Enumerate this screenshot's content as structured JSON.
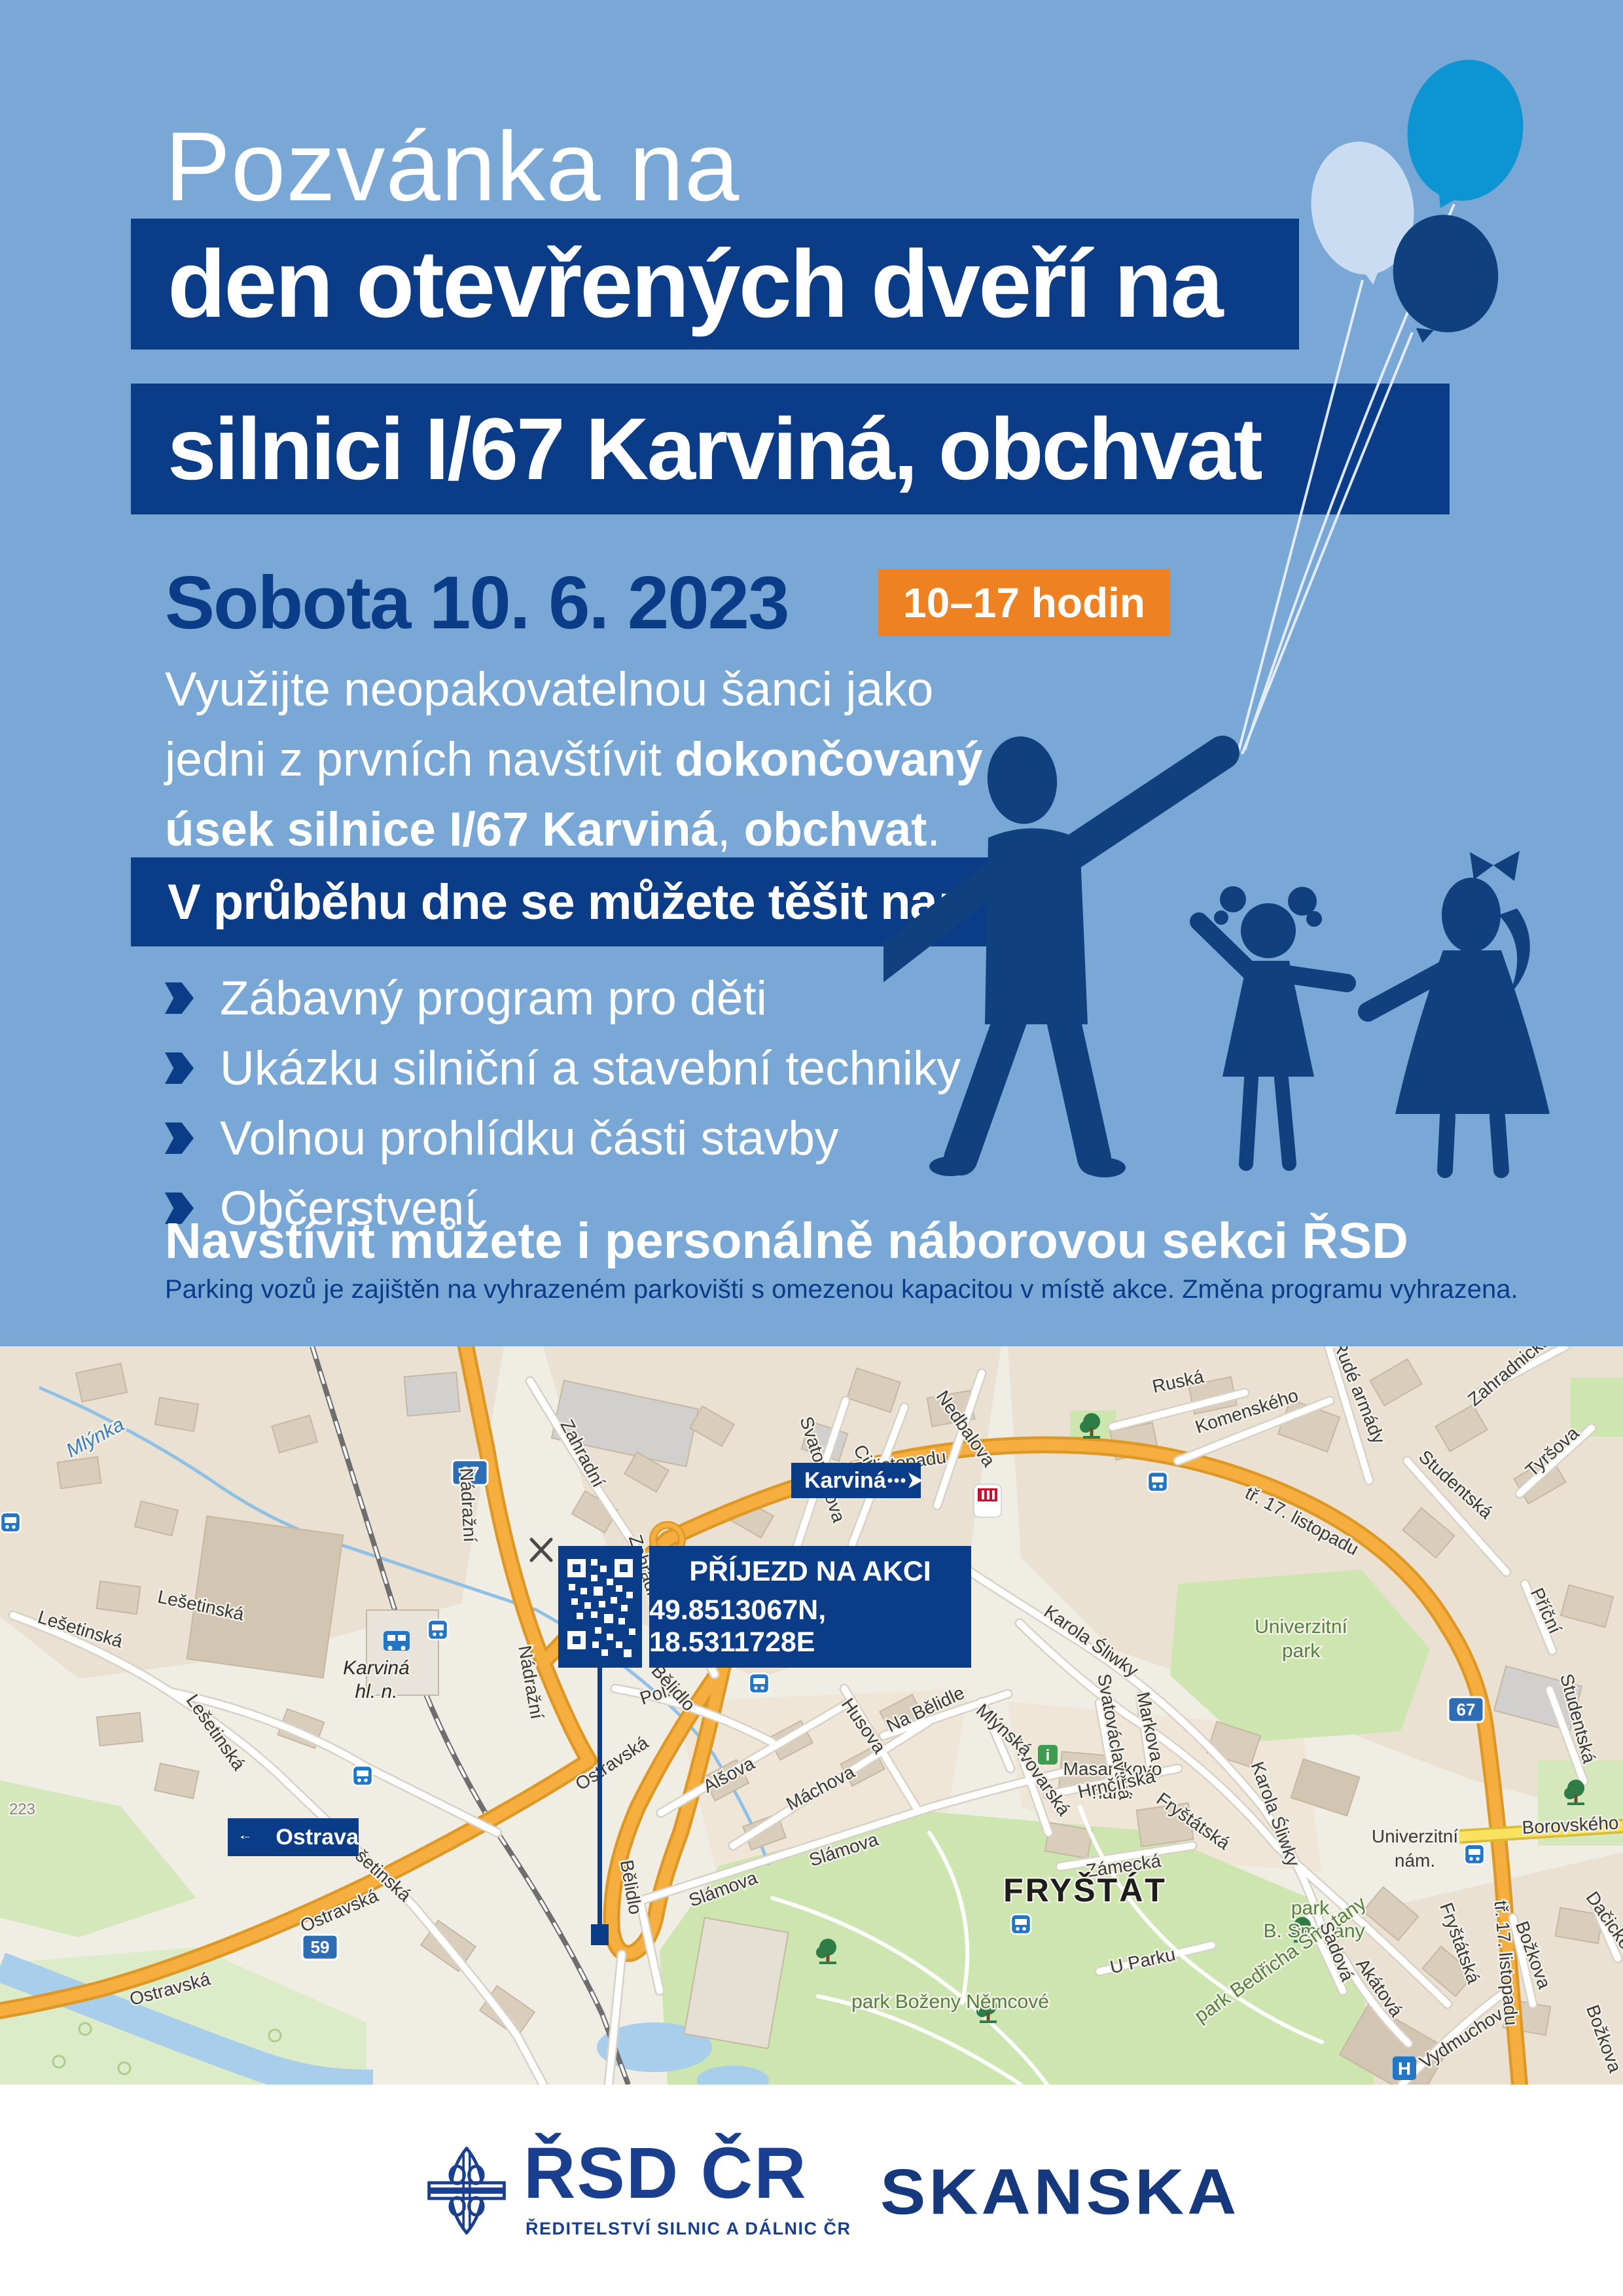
{
  "poster": {
    "eyebrow": "Pozvánka na",
    "title_line1": "den otevřených dveří na",
    "title_line2": "silnici I/67 Karviná, obchvat",
    "date": "Sobota 10. 6. 2023",
    "time_badge": "10–17 hodin",
    "intro": {
      "line1": "Využijte neopakovatelnou šanci jako",
      "line2_regular": "jedni z prvních navštívit ",
      "line2_bold": "dokončovaný",
      "line3_bold1": "úsek silnice I/67 Karviná",
      "line3_sep": ", ",
      "line3_bold2": "obchvat",
      "line3_end": "."
    },
    "list_header": "V průběhu dne se můžete těšit na:",
    "list_items": [
      "Zábavný program pro děti",
      "Ukázku silniční a stavební techniky",
      "Volnou prohlídku části stavby",
      "Občerstvení"
    ],
    "note_bold": "Navštívit můžete i personálně náborovou sekci ŘSD",
    "note_small": "Parking vozů je zajištěn na vyhrazeném parkovišti s omezenou kapacitou v místě akce. Změna programu vyhrazena."
  },
  "map": {
    "overlays": {
      "karvina": "Karviná",
      "ostrava": "Ostrava",
      "arrival_title": "PŘÍJEZD NA AKCI",
      "arrival_coords": "49.8513067N, 18.5311728E"
    },
    "road_badges": [
      {
        "id": "b67a",
        "text": "67"
      },
      {
        "id": "b67b",
        "text": "67"
      },
      {
        "id": "b59",
        "text": "59"
      }
    ],
    "labels": [
      {
        "id": "mlynka",
        "text": "Mlýnka",
        "kind": "water"
      },
      {
        "id": "r223",
        "text": "223",
        "kind": "ref"
      },
      {
        "id": "lesetinska1",
        "text": "Lešetinská",
        "kind": "street"
      },
      {
        "id": "lesetinska2",
        "text": "Lešetinská",
        "kind": "street"
      },
      {
        "id": "lesetinska3",
        "text": "Lešetinská",
        "kind": "street"
      },
      {
        "id": "lesetinska4",
        "text": "Lešetinská",
        "kind": "street"
      },
      {
        "id": "nadrazni1",
        "text": "Nádražní",
        "kind": "street"
      },
      {
        "id": "nadrazni2",
        "text": "Nádražní",
        "kind": "street"
      },
      {
        "id": "ostravska1",
        "text": "Ostravská",
        "kind": "street"
      },
      {
        "id": "ostravska3",
        "text": "Ostravská",
        "kind": "street"
      },
      {
        "id": "ostravska4",
        "text": "Ostravská",
        "kind": "street"
      },
      {
        "id": "zahradni1",
        "text": "Zahradní",
        "kind": "street"
      },
      {
        "id": "zahradni2",
        "text": "Zahradní",
        "kind": "street"
      },
      {
        "id": "svatoplukova",
        "text": "Svatoplukova",
        "kind": "street"
      },
      {
        "id": "cihelni",
        "text": "Cihelní",
        "kind": "street"
      },
      {
        "id": "nedbalova",
        "text": "Nedbalova",
        "kind": "street"
      },
      {
        "id": "polni",
        "text": "Polní",
        "kind": "street"
      },
      {
        "id": "belidlo1",
        "text": "Bělidlo",
        "kind": "street"
      },
      {
        "id": "belidlo2",
        "text": "Bělidlo",
        "kind": "street"
      },
      {
        "id": "alsova",
        "text": "Alšova",
        "kind": "street"
      },
      {
        "id": "machova",
        "text": "Máchova",
        "kind": "street"
      },
      {
        "id": "husova",
        "text": "Husova",
        "kind": "street"
      },
      {
        "id": "nabelidle",
        "text": "Na Bělidle",
        "kind": "street"
      },
      {
        "id": "slamova1",
        "text": "Slámova",
        "kind": "street"
      },
      {
        "id": "slamova2",
        "text": "Slámova",
        "kind": "street"
      },
      {
        "id": "karola1",
        "text": "Karola Śliwky",
        "kind": "street"
      },
      {
        "id": "karola2",
        "text": "Karola Śliwky",
        "kind": "street"
      },
      {
        "id": "t17a",
        "text": "tř. 17. listopadu",
        "kind": "street"
      },
      {
        "id": "t17b",
        "text": "tř. 17. listopadu",
        "kind": "street"
      },
      {
        "id": "t17c",
        "text": "tř. 17. listopadu",
        "kind": "street"
      },
      {
        "id": "ruska",
        "text": "Ruská",
        "kind": "street"
      },
      {
        "id": "komenskeho",
        "text": "Komenského",
        "kind": "street"
      },
      {
        "id": "rudearmady",
        "text": "Rudé armády",
        "kind": "street"
      },
      {
        "id": "studentska1",
        "text": "Studentská",
        "kind": "street"
      },
      {
        "id": "studentska2",
        "text": "Studentská",
        "kind": "street"
      },
      {
        "id": "tyrsova",
        "text": "Tyršova",
        "kind": "street"
      },
      {
        "id": "zahradnicka",
        "text": "Zahradnická",
        "kind": "street"
      },
      {
        "id": "pricni",
        "text": "Příční",
        "kind": "street"
      },
      {
        "id": "borovskeho",
        "text": "Borovského",
        "kind": "street"
      },
      {
        "id": "univpark1",
        "text": "Univerzitní",
        "kind": "green"
      },
      {
        "id": "univpark2",
        "text": "park",
        "kind": "green"
      },
      {
        "id": "univnam1",
        "text": "Univerzitní",
        "kind": "street"
      },
      {
        "id": "univnam2",
        "text": "nám.",
        "kind": "street"
      },
      {
        "id": "masaryk1",
        "text": "Masarykovo",
        "kind": "street"
      },
      {
        "id": "masaryk2",
        "text": "nám.",
        "kind": "street"
      },
      {
        "id": "svatovaclavska",
        "text": "Svatováclavská",
        "kind": "street"
      },
      {
        "id": "markova",
        "text": "Markova",
        "kind": "street"
      },
      {
        "id": "pivovarska",
        "text": "Pivovarská",
        "kind": "street"
      },
      {
        "id": "mlynska",
        "text": "Mlýnská",
        "kind": "street"
      },
      {
        "id": "hrncirska",
        "text": "Hrnčířská",
        "kind": "street"
      },
      {
        "id": "zamecka",
        "text": "Zámecká",
        "kind": "street"
      },
      {
        "id": "frystatska1",
        "text": "Fryštátská",
        "kind": "street"
      },
      {
        "id": "frystatska2",
        "text": "Fryštátská",
        "kind": "street"
      },
      {
        "id": "uparku",
        "text": "U Parku",
        "kind": "street"
      },
      {
        "id": "frystat",
        "text": "FRYŠTÁT",
        "kind": "district"
      },
      {
        "id": "parkbn",
        "text": "park Boženy Němcové",
        "kind": "green"
      },
      {
        "id": "parkbs1",
        "text": "park",
        "kind": "green"
      },
      {
        "id": "parkbs2",
        "text": "B. Smetany",
        "kind": "green"
      },
      {
        "id": "parkbeds",
        "text": "park Bedřicha Smetany",
        "kind": "green"
      },
      {
        "id": "sadova",
        "text": "Sadová",
        "kind": "street"
      },
      {
        "id": "akatova",
        "text": "Akátová",
        "kind": "street"
      },
      {
        "id": "vydmuchov",
        "text": "Vydmuchov",
        "kind": "street"
      },
      {
        "id": "bozkova1",
        "text": "Božkova",
        "kind": "street"
      },
      {
        "id": "bozkova2",
        "text": "Božkova",
        "kind": "street"
      },
      {
        "id": "dacickeho",
        "text": "Dačického",
        "kind": "street"
      },
      {
        "id": "stanice1",
        "text": "Karviná",
        "kind": "station"
      },
      {
        "id": "stanice2",
        "text": "hl. n.",
        "kind": "station"
      }
    ],
    "icons": {
      "bus_stop": "bus-icon",
      "train_station": "train-icon",
      "hospital": "H",
      "kfc": "KFC"
    }
  },
  "footer": {
    "rsd_name": "ŘSD ČR",
    "rsd_subtitle": "ŘEDITELSTVÍ SILNIC A DÁLNIC ČR",
    "partner": "SKANSKA"
  },
  "colors": {
    "background": "#79A7D6",
    "navy": "#0B3C87",
    "orange": "#EE8222",
    "balloon_pale": "#C9DCF1",
    "balloon_bright": "#0D94D2",
    "balloon_navy": "#11407F",
    "map_road_orange": "#F6AF3F",
    "map_road_yellow": "#F8E25F",
    "map_green": "#CDE5AF",
    "map_water": "#A9CEEC"
  }
}
